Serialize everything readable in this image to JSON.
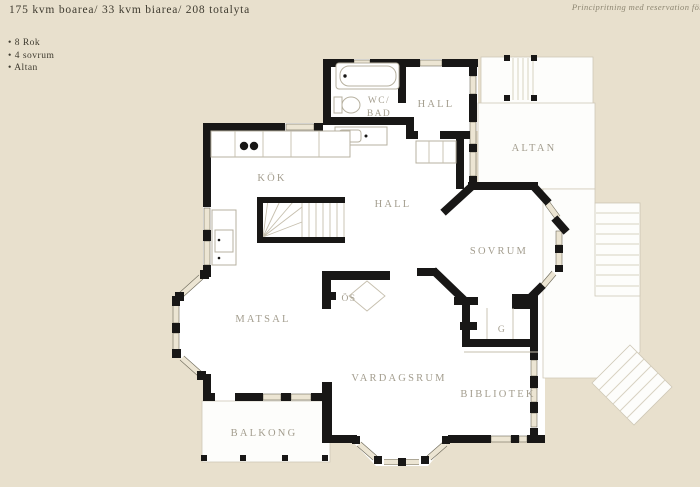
{
  "header": {
    "area_summary": "175 kvm boarea/ 33 kvm biarea/ 208 totalyta",
    "bullet": "•",
    "features": [
      "8 Rok",
      "4 sovrum",
      "Altan"
    ],
    "disclaimer": "Principritning med reservation för"
  },
  "rooms": {
    "wc_bad": {
      "line1": "WC/",
      "line2": "BAD"
    },
    "hall_upper": {
      "label": "HALL"
    },
    "altan": {
      "label": "ALTAN"
    },
    "kok": {
      "label": "KÖK"
    },
    "hall": {
      "label": "HALL"
    },
    "sovrum": {
      "label": "SOVRUM"
    },
    "matsal": {
      "label": "MATSAL"
    },
    "oppen_spis": {
      "label": "ÖS"
    },
    "garderob": {
      "label": "G"
    },
    "vardagsrum": {
      "label": "VARDAGSRUM"
    },
    "bibliotek": {
      "label": "BIBLIOTEK"
    },
    "balkong": {
      "label": "BALKONG"
    }
  },
  "colors": {
    "background": "#e8e0cd",
    "floor": "#ffffff",
    "wall": "#181716",
    "room_label": "#a39d8e",
    "heading_text": "#3e3a2f",
    "disclaimer_text": "#8d8672",
    "window_band": "#ece5d3"
  }
}
